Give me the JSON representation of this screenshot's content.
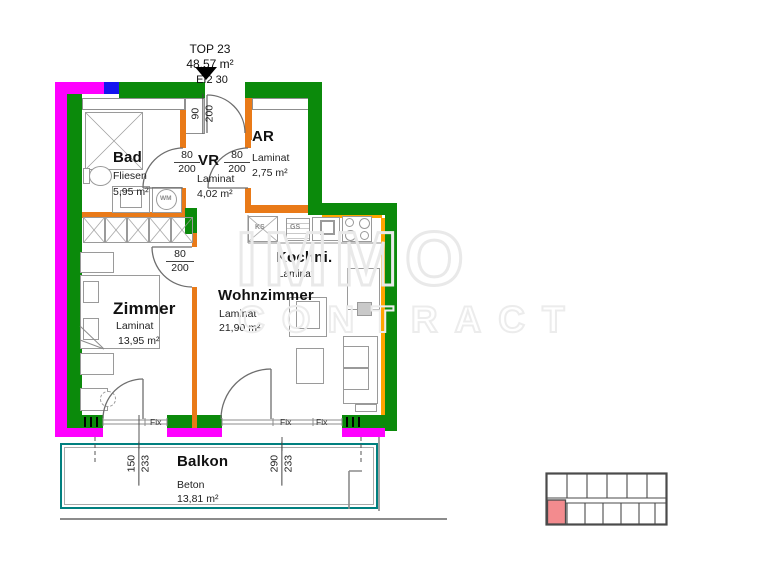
{
  "header": {
    "unit": "TOP 23",
    "area": "48,57 m²",
    "fire_rating": "EI2 30"
  },
  "rooms": {
    "bad": {
      "name": "Bad",
      "floor": "Fliesen",
      "area": "5,95 m²"
    },
    "vr": {
      "name": "VR",
      "floor": "Laminat",
      "area": "4,02 m²"
    },
    "ar": {
      "name": "AR",
      "floor": "Laminat",
      "area": "2,75 m²"
    },
    "kochni": {
      "name": "Kochni.",
      "floor": "Laminat"
    },
    "wohnzimmer": {
      "name": "Wohnzimmer",
      "floor": "Laminat",
      "area": "21,90 m²"
    },
    "zimmer": {
      "name": "Zimmer",
      "floor": "Laminat",
      "area": "13,95 m²"
    },
    "balkon": {
      "name": "Balkon",
      "floor": "Beton",
      "area": "13,81 m²"
    }
  },
  "dimensions": {
    "entrance_door": {
      "width": "90",
      "height": "200"
    },
    "bad_door": {
      "width": "80",
      "height": "200"
    },
    "ar_door": {
      "width": "80",
      "height": "200"
    },
    "zimmer_door": {
      "width": "80",
      "height": "200"
    },
    "balcony_door_zimmer": {
      "width": "150",
      "height": "233"
    },
    "balcony_door_wohnzimmer": {
      "width": "290",
      "height": "233"
    }
  },
  "windows": {
    "fix1": "Fix",
    "fix2": "Fix",
    "fix3": "Fix"
  },
  "appliances": {
    "washing_machine": "WM",
    "fridge": "KS",
    "dishwasher": "GS"
  },
  "watermark": {
    "line1": "IMMO",
    "line2": "CONTRACT"
  },
  "colors": {
    "exterior_wall_magenta": "#FF00FF",
    "insulation_green": "#0B8A0B",
    "interior_wall_orange": "#E97A18",
    "accent_yellow": "#FFA500",
    "shaft_blue": "#1414F0",
    "balcony_outline_teal": "#00807F",
    "minimap_highlight_red": "#F38B8E"
  }
}
